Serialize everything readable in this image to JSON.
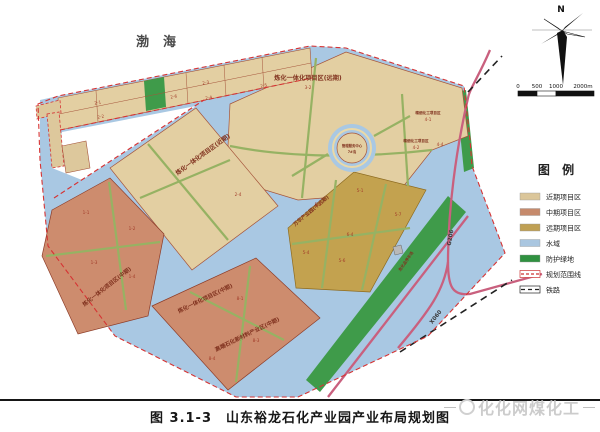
{
  "title": {
    "caption": "图 3.1-3　山东裕龙石化产业园产业布局规划图"
  },
  "watermark": {
    "text": "化化网煤化工"
  },
  "sea": {
    "label": "渤海"
  },
  "compass": {
    "label": "N"
  },
  "scale": {
    "ticks": [
      "0",
      "500",
      "1000",
      "2000m"
    ]
  },
  "legend": {
    "title": "图 例",
    "items": [
      {
        "label": "近期项目区",
        "color": "#dbc69a"
      },
      {
        "label": "中期项目区",
        "color": "#c68a6c"
      },
      {
        "label": "远期项目区",
        "color": "#bfa054"
      },
      {
        "label": "水域",
        "color": "#a9c6e0"
      },
      {
        "label": "防护绿地",
        "color": "#2f9140"
      },
      {
        "label": "规划范围线",
        "color": "#cc3333"
      },
      {
        "label": "铁路",
        "color": "#222222"
      }
    ]
  },
  "map": {
    "zones": {
      "refinery_far": "炼化一体化项目区(远期)",
      "refinery_far_sub": "3-2",
      "refinery_near": "炼化一体化项目区(近期)",
      "refinery_mid_west": "炼化一体化项目区(中期)",
      "refinery_mid_south": "炼化一体化项目区(中期)",
      "new_material": "高端石化新材料产业区(中期)",
      "wanhua": "万华产业园(中远期)",
      "fine_chem_a": "精细化工项目区",
      "fine_chem_b": "精细化工项目区",
      "mgmt_center_line1": "管理服务中心",
      "mgmt_center_line2": "7#岛",
      "parking": "危化品停车场"
    },
    "roads": {
      "g206": "G206",
      "x060": "X060"
    },
    "parcels": [
      "1-1",
      "1-2",
      "1-3",
      "1-4",
      "2-1",
      "2-2",
      "2-6",
      "2-3",
      "2-4",
      "2-5",
      "4-1",
      "4-2",
      "4-4",
      "2-4",
      "5-1",
      "5-2",
      "5-4",
      "5-6",
      "5-7",
      "6-4",
      "8-1",
      "8-3",
      "8-4"
    ]
  }
}
